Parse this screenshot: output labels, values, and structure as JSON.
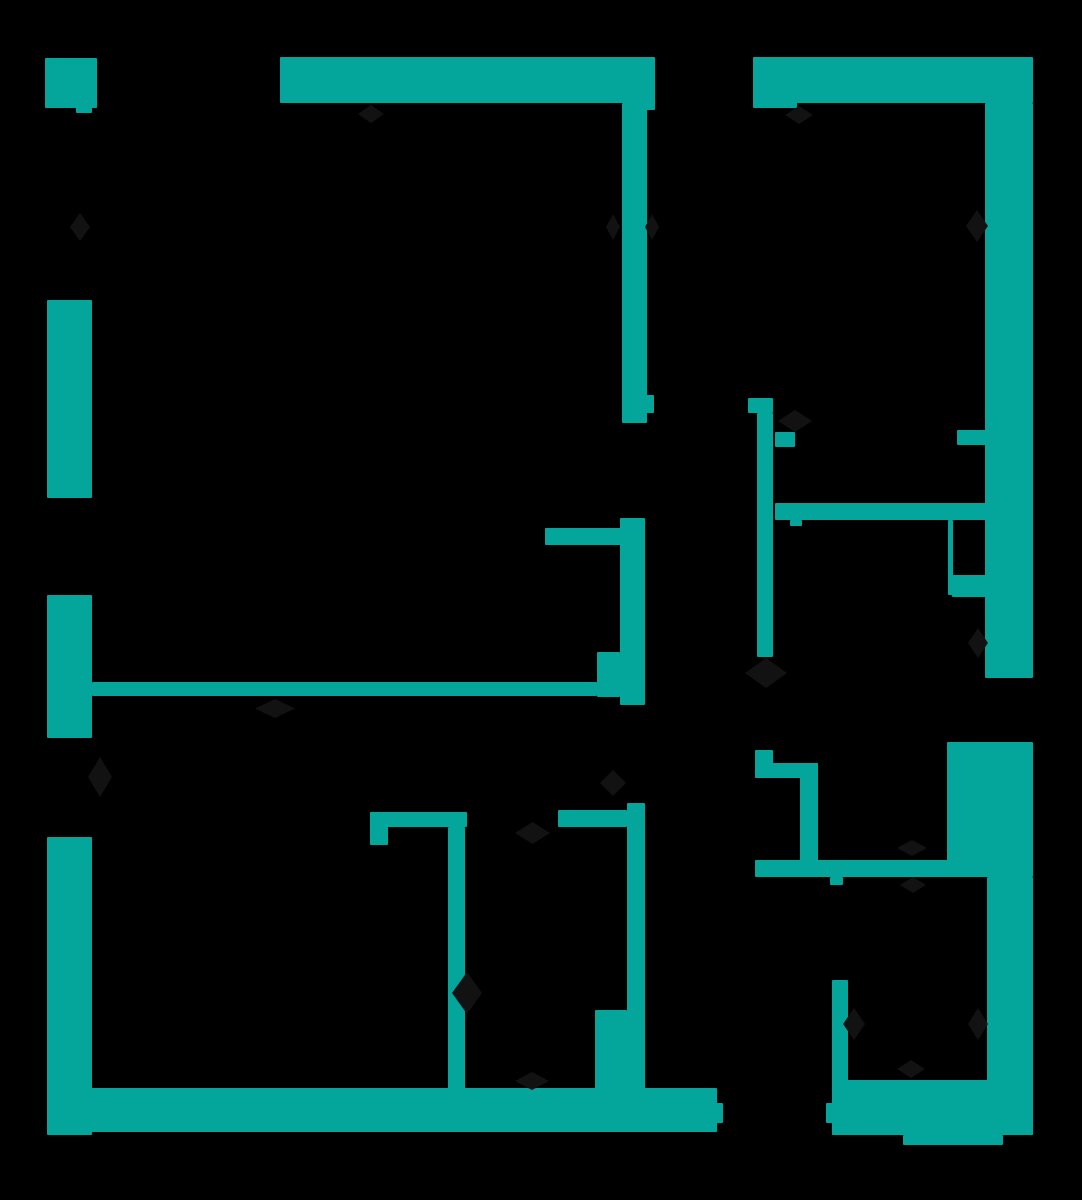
{
  "floorplan": {
    "description": "apartment floor plan, teal walls on black background",
    "canvas": {
      "width": 1082,
      "height": 1200
    },
    "colors": {
      "background": "#000000",
      "wall": "#04A69B",
      "symbol": "#121212"
    },
    "walls": [
      {
        "name": "top-left-corner-block",
        "x": 45,
        "y": 58,
        "w": 52,
        "h": 50
      },
      {
        "name": "top-left-corner-tail",
        "x": 76,
        "y": 103,
        "w": 16,
        "h": 10
      },
      {
        "name": "top-wall-west",
        "x": 280,
        "y": 57,
        "w": 375,
        "h": 46
      },
      {
        "name": "top-wall-west-end-tab",
        "x": 645,
        "y": 100,
        "w": 10,
        "h": 10
      },
      {
        "name": "top-wall-east",
        "x": 753,
        "y": 57,
        "w": 280,
        "h": 46
      },
      {
        "name": "top-wall-east-end-tab",
        "x": 753,
        "y": 100,
        "w": 44,
        "h": 8
      },
      {
        "name": "right-wall-upper",
        "x": 985,
        "y": 103,
        "w": 48,
        "h": 575
      },
      {
        "name": "right-wall-mid-pier",
        "x": 947,
        "y": 742,
        "w": 86,
        "h": 135
      },
      {
        "name": "right-wall-lower",
        "x": 987,
        "y": 877,
        "w": 46,
        "h": 258
      },
      {
        "name": "left-wall-upper",
        "x": 47,
        "y": 300,
        "w": 45,
        "h": 198
      },
      {
        "name": "left-wall-middle",
        "x": 47,
        "y": 595,
        "w": 45,
        "h": 143
      },
      {
        "name": "left-wall-lower",
        "x": 47,
        "y": 837,
        "w": 45,
        "h": 298
      },
      {
        "name": "bottom-wall-west",
        "x": 47,
        "y": 1088,
        "w": 670,
        "h": 44
      },
      {
        "name": "bottom-wall-west-hinge-nub",
        "x": 715,
        "y": 1103,
        "w": 8,
        "h": 20
      },
      {
        "name": "bottom-wall-east",
        "x": 832,
        "y": 1080,
        "w": 201,
        "h": 55
      },
      {
        "name": "bottom-wall-east-hinge-nub",
        "x": 826,
        "y": 1103,
        "w": 8,
        "h": 20
      },
      {
        "name": "bottom-wall-east-bump",
        "x": 903,
        "y": 1135,
        "w": 100,
        "h": 10
      },
      {
        "name": "bedroom1-east-wall-upper",
        "x": 622,
        "y": 103,
        "w": 25,
        "h": 320
      },
      {
        "name": "bedroom1-east-wall-tab",
        "x": 645,
        "y": 395,
        "w": 9,
        "h": 18
      },
      {
        "name": "bedroom1-east-wall-lower",
        "x": 620,
        "y": 518,
        "w": 25,
        "h": 187
      },
      {
        "name": "kitchen-stub-wall",
        "x": 545,
        "y": 528,
        "w": 78,
        "h": 17
      },
      {
        "name": "hall-junction-pier",
        "x": 597,
        "y": 652,
        "w": 23,
        "h": 45
      },
      {
        "name": "living-divider-wall",
        "x": 92,
        "y": 682,
        "w": 505,
        "h": 14
      },
      {
        "name": "hall-east-wall-foot",
        "x": 748,
        "y": 398,
        "w": 25,
        "h": 15
      },
      {
        "name": "hall-east-wall",
        "x": 757,
        "y": 413,
        "w": 16,
        "h": 244
      },
      {
        "name": "wc-wall-stub",
        "x": 755,
        "y": 750,
        "w": 18,
        "h": 28
      },
      {
        "name": "wc-wall-top",
        "x": 755,
        "y": 763,
        "w": 63,
        "h": 15
      },
      {
        "name": "wc-wall-east",
        "x": 800,
        "y": 763,
        "w": 18,
        "h": 100
      },
      {
        "name": "hall-south-wall",
        "x": 755,
        "y": 860,
        "w": 232,
        "h": 17
      },
      {
        "name": "hall-south-wall-tab",
        "x": 830,
        "y": 877,
        "w": 13,
        "h": 8
      },
      {
        "name": "bath-north-stub-west",
        "x": 775,
        "y": 432,
        "w": 20,
        "h": 15
      },
      {
        "name": "bath-north-stub-east",
        "x": 957,
        "y": 430,
        "w": 30,
        "h": 15
      },
      {
        "name": "bath-south-wall",
        "x": 775,
        "y": 503,
        "w": 212,
        "h": 17
      },
      {
        "name": "bath-south-wall-nub",
        "x": 790,
        "y": 520,
        "w": 12,
        "h": 6
      },
      {
        "name": "shower-screen",
        "x": 948,
        "y": 520,
        "w": 5,
        "h": 75
      },
      {
        "name": "shower-block",
        "x": 952,
        "y": 575,
        "w": 35,
        "h": 22
      },
      {
        "name": "bedroom2-north-wall-west",
        "x": 370,
        "y": 812,
        "w": 97,
        "h": 15
      },
      {
        "name": "bedroom2-north-wall-tab",
        "x": 370,
        "y": 812,
        "w": 18,
        "h": 33
      },
      {
        "name": "bedroom2-north-wall-east",
        "x": 558,
        "y": 810,
        "w": 69,
        "h": 17
      },
      {
        "name": "bedroom2-east-wall",
        "x": 448,
        "y": 827,
        "w": 17,
        "h": 266
      },
      {
        "name": "bedroom3-east-wall",
        "x": 627,
        "y": 803,
        "w": 18,
        "h": 290
      },
      {
        "name": "bedroom3-east-pier",
        "x": 595,
        "y": 1010,
        "w": 32,
        "h": 85
      },
      {
        "name": "entry-room-west-wall",
        "x": 832,
        "y": 980,
        "w": 16,
        "h": 155
      }
    ],
    "symbols": [
      {
        "name": "window-break-symbol-left-upper",
        "x": 70,
        "y": 213,
        "w": 20,
        "h": 28
      },
      {
        "name": "door-swing-symbol-top-wall-west",
        "x": 358,
        "y": 105,
        "w": 26,
        "h": 18
      },
      {
        "name": "door-swing-symbol-top-wall-east",
        "x": 785,
        "y": 106,
        "w": 28,
        "h": 18
      },
      {
        "name": "window-pinch-symbol-bedroom1-west",
        "x": 606,
        "y": 214,
        "w": 14,
        "h": 26
      },
      {
        "name": "window-pinch-symbol-bedroom1-east",
        "x": 645,
        "y": 214,
        "w": 14,
        "h": 26
      },
      {
        "name": "door-swing-symbol-right-wall-upper",
        "x": 966,
        "y": 210,
        "w": 22,
        "h": 32
      },
      {
        "name": "door-swing-symbol-bath-entry",
        "x": 778,
        "y": 410,
        "w": 34,
        "h": 22
      },
      {
        "name": "door-swing-symbol-balcony",
        "x": 968,
        "y": 628,
        "w": 20,
        "h": 30
      },
      {
        "name": "door-swing-symbol-hall-east-wall",
        "x": 745,
        "y": 658,
        "w": 42,
        "h": 30
      },
      {
        "name": "door-swing-symbol-living-divider",
        "x": 255,
        "y": 699,
        "w": 40,
        "h": 19
      },
      {
        "name": "door-swing-symbol-bedroom3-top",
        "x": 600,
        "y": 770,
        "w": 26,
        "h": 26
      },
      {
        "name": "door-swing-symbol-bedroom2-door",
        "x": 515,
        "y": 822,
        "w": 35,
        "h": 22
      },
      {
        "name": "door-swing-symbol-hall-south-above",
        "x": 897,
        "y": 840,
        "w": 30,
        "h": 16
      },
      {
        "name": "door-swing-symbol-hall-south-below",
        "x": 900,
        "y": 877,
        "w": 26,
        "h": 16
      },
      {
        "name": "window-break-symbol-bedroom2-wall",
        "x": 452,
        "y": 972,
        "w": 30,
        "h": 42
      },
      {
        "name": "door-swing-symbol-entry-room-west",
        "x": 843,
        "y": 1008,
        "w": 22,
        "h": 32
      },
      {
        "name": "door-swing-symbol-entry-room-east",
        "x": 968,
        "y": 1008,
        "w": 20,
        "h": 32
      },
      {
        "name": "window-break-symbol-bottom-west",
        "x": 515,
        "y": 1072,
        "w": 34,
        "h": 18
      },
      {
        "name": "window-break-symbol-bottom-east",
        "x": 897,
        "y": 1060,
        "w": 28,
        "h": 18
      },
      {
        "name": "door-swing-symbol-left-wall-door",
        "x": 88,
        "y": 757,
        "w": 24,
        "h": 40
      }
    ]
  }
}
